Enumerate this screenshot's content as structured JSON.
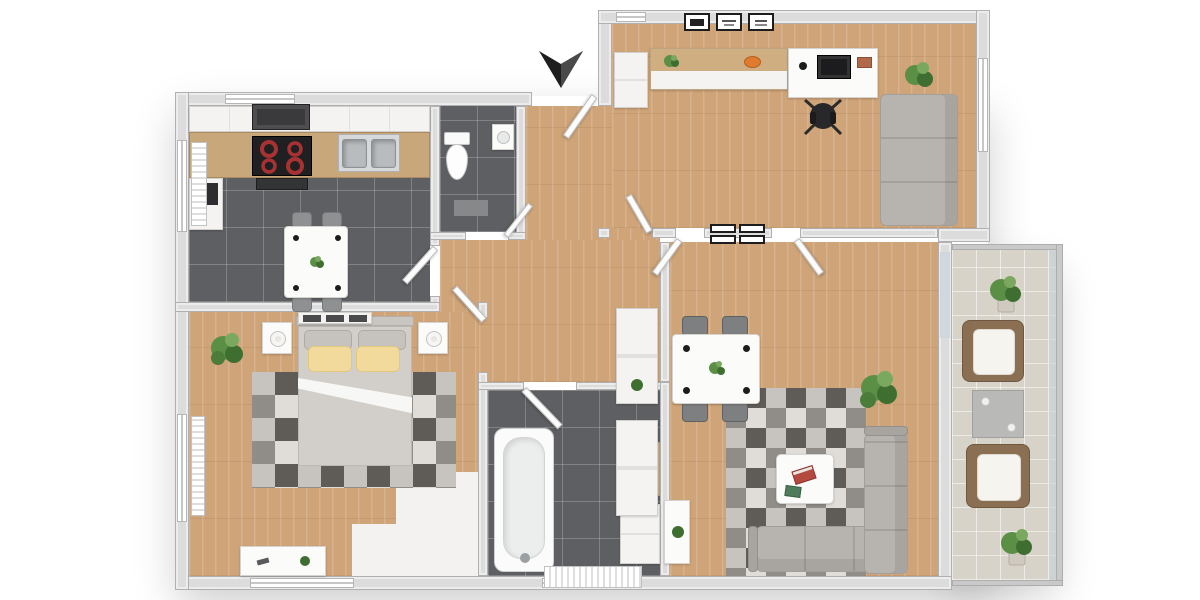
{
  "title": "3d-floor-plan-top-view",
  "palette": {
    "wall": "#dcdcdc",
    "wallEdge": "#b0b0b0",
    "wood": "#cfa478",
    "counterWood": "#c8a77b",
    "woodTop": "#cfae82",
    "tileDark": "#5d5f62",
    "balconyTile": "#d8d3c8",
    "cabinet": "#f4f3f1",
    "white": "#fafafa",
    "stove": "#202022",
    "burner": "#a83232",
    "steel": "#b9bcbf",
    "couch": "#b7b3af",
    "couchDark": "#a29e9a",
    "rugA": "#e0ddd9",
    "rugB": "#c7c4c0",
    "rugC": "#908d89",
    "rugD": "#5f5c58",
    "bedBlanket": "#d2cfca",
    "pillowYellow": "#f1da9b",
    "pillowEdge": "#e3c87f",
    "plant": "#5c8f46",
    "plantDark": "#3f6e31",
    "chairGray": "#8f9092",
    "chairBlack": "#28282a",
    "orange": "#e07b2e",
    "bookRed": "#b3493f",
    "bookGreen": "#4f7d5c",
    "armFrame": "#8a6f52",
    "armCushion": "#f6f4ef",
    "arrow": "#1e1e1e"
  },
  "floorplan": {
    "view": "top-down",
    "entrance_marker": "black-chevron-arrow-pointing-in",
    "rooms": [
      {
        "name": "kitchen",
        "floor": "dark-tile",
        "furniture": [
          "upper-cabinets",
          "microwave-hood",
          "counter",
          "stove-4-burners",
          "oven",
          "double-sink",
          "tall-unit",
          "dining-table",
          "four-chairs",
          "radiator",
          "windows"
        ]
      },
      {
        "name": "wc",
        "floor": "dark-tile",
        "furniture": [
          "toilet",
          "corner-sink",
          "mat",
          "door"
        ]
      },
      {
        "name": "entrance-hall",
        "floor": "wood",
        "furniture": [
          "entrance-door",
          "tall-cabinets"
        ]
      },
      {
        "name": "office",
        "floor": "wood",
        "furniture": [
          "three-wall-frames",
          "wardrobe",
          "sideboard",
          "plant-pot",
          "orange-bowl",
          "desk",
          "monitor",
          "mug",
          "red-item",
          "office-chair",
          "sofa",
          "floor-plant",
          "window"
        ]
      },
      {
        "name": "bedroom",
        "floor": "wood",
        "furniture": [
          "drawer-chest",
          "double-bed",
          "gray-pillows",
          "yellow-pillows",
          "white-sheet-fold",
          "nightstand-left",
          "nightstand-right",
          "lamps",
          "geometric-rug",
          "plant",
          "desk",
          "wardrobe-nook",
          "radiator",
          "windows",
          "door"
        ]
      },
      {
        "name": "bathroom",
        "floor": "dark-tile",
        "furniture": [
          "bathtub",
          "vanity-sink",
          "cabinet",
          "radiator",
          "window",
          "door"
        ]
      },
      {
        "name": "living-room",
        "floor": "wood",
        "furniture": [
          "four-wall-plaques",
          "dining-table",
          "four-chairs",
          "geometric-rug",
          "corner-sofa",
          "coffee-table",
          "books",
          "floor-plant",
          "console-table",
          "two-doors",
          "balcony-glass-door"
        ]
      },
      {
        "name": "balcony",
        "floor": "light-tile",
        "furniture": [
          "potted-plant-top",
          "armchair",
          "side-table",
          "armchair",
          "potted-plant-bottom",
          "glass-railing"
        ]
      }
    ]
  }
}
